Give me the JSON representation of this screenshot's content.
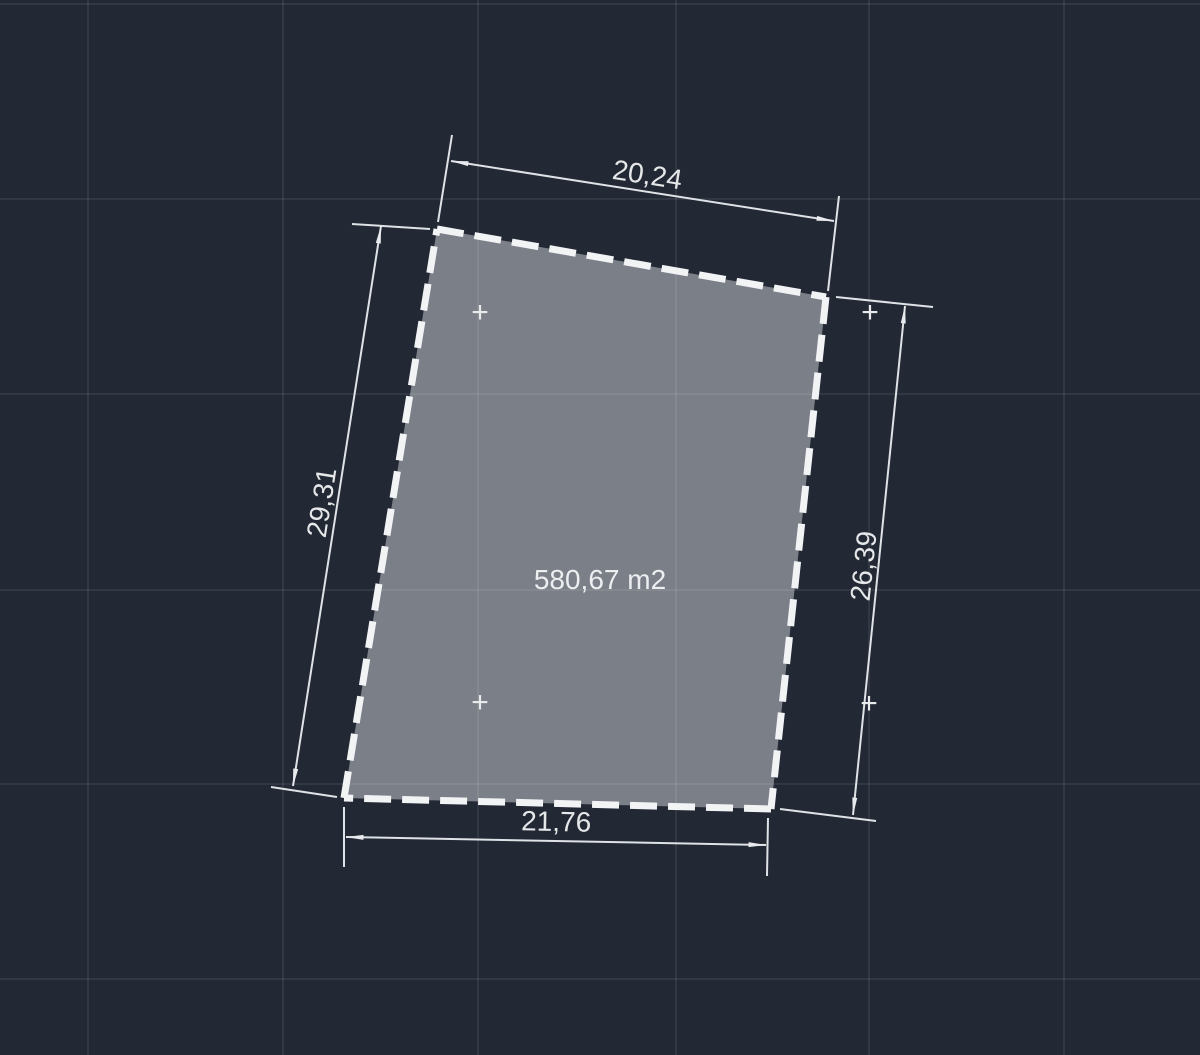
{
  "canvas": {
    "background_color": "#222834",
    "grid_color": "rgba(255,255,255,0.075)"
  },
  "parcel": {
    "area_label": "580,67 m2",
    "fill_color": "#7b7f87",
    "outline_color": "#f2f3f5"
  },
  "dimensions": {
    "top": "20,24",
    "left": "29,31",
    "right": "26,39",
    "bottom": "21,76"
  },
  "markers": {
    "grid_cross_glyph": "+"
  },
  "colors": {
    "dimension_line": "#dfe2e6",
    "dimension_text": "#e6e7e9"
  }
}
